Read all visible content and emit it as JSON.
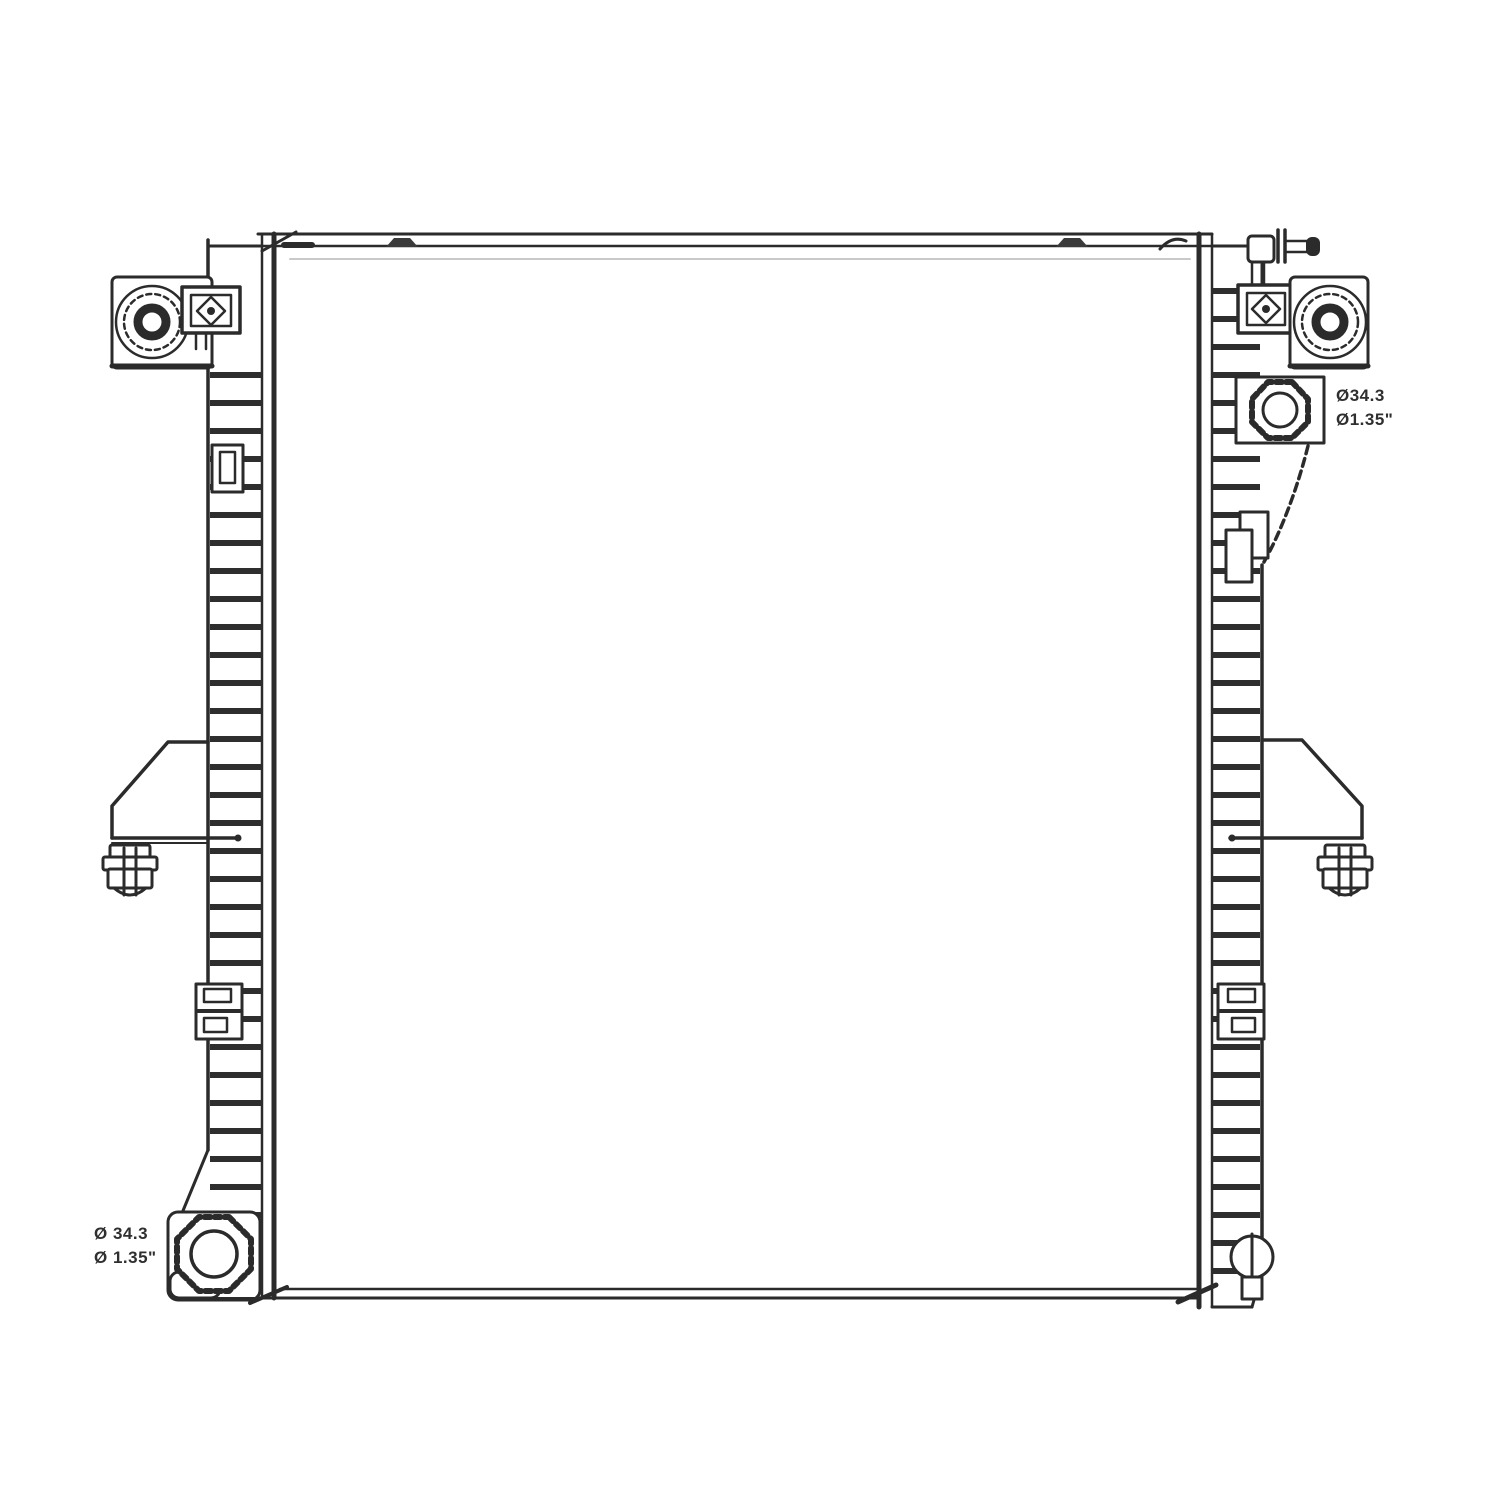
{
  "page": {
    "background": "#ffffff"
  },
  "drawing": {
    "description": "Radiator front-view technical line drawing",
    "line_color": "#2b2b2b"
  },
  "annotations": {
    "inlet": {
      "line1": "Ø34.3",
      "line2": "Ø1.35\""
    },
    "outlet": {
      "line1": "Ø 34.3",
      "line2": "Ø 1.35\""
    }
  }
}
